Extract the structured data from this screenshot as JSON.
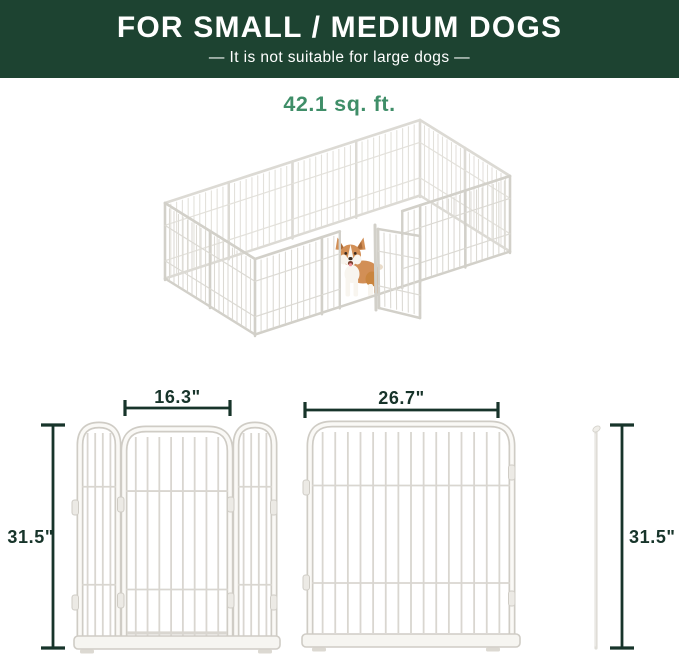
{
  "banner": {
    "title": "FOR SMALL / MEDIUM DOGS",
    "subtitle": "—  It is not suitable for large dogs  —"
  },
  "area_label": "42.1 sq. ft.",
  "dimensions": {
    "door_width": "16.3\"",
    "panel_width": "26.7\"",
    "panel_height": "31.5\"",
    "rod_height": "31.5\""
  },
  "colors": {
    "banner_bg": "#1d4331",
    "banner_text": "#ffffff",
    "accent_green": "#3f8e68",
    "dimension_color": "#17342a",
    "pen_metal": "#d6d4cd",
    "dog_coat": "#d28f56"
  }
}
